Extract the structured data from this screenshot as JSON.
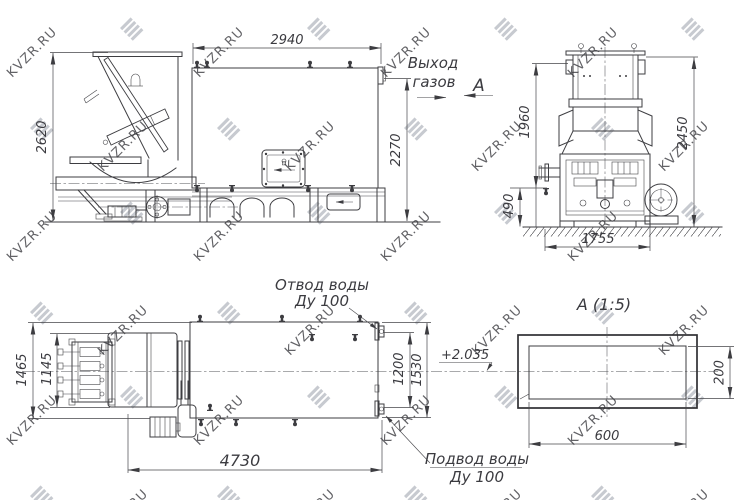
{
  "watermark": {
    "text": "KVZR.RU",
    "logo_icon": "diagonal-stripes-logo",
    "color": "#b9bdc4"
  },
  "palette": {
    "line": "#3d3d41",
    "background": "#ffffff"
  },
  "views": {
    "side": {
      "dim_height_overall": "2620",
      "dim_width_top": "2940",
      "dim_height_right": "2270",
      "gas_outlet_label": [
        "Выход",
        "газов"
      ],
      "view_direction_marker": "А"
    },
    "front": {
      "dim_height_upper": "1960",
      "dim_height_overall": "2450",
      "dim_height_base": "490",
      "dim_width_base": "1755"
    },
    "plan": {
      "dim_width_overall": "1465",
      "dim_width_inner": "1145",
      "dim_length_overall": "4730",
      "dim_right_inner": "1200",
      "dim_right_outer": "1530",
      "elevation_mark": "+2.035",
      "water_outlet_label": [
        "Отвод воды",
        "Ду 100"
      ],
      "water_inlet_label": [
        "Подвод воды",
        "Ду 100"
      ]
    },
    "section": {
      "title": "А (1:5)",
      "dim_width": "600",
      "dim_height": "200"
    }
  }
}
